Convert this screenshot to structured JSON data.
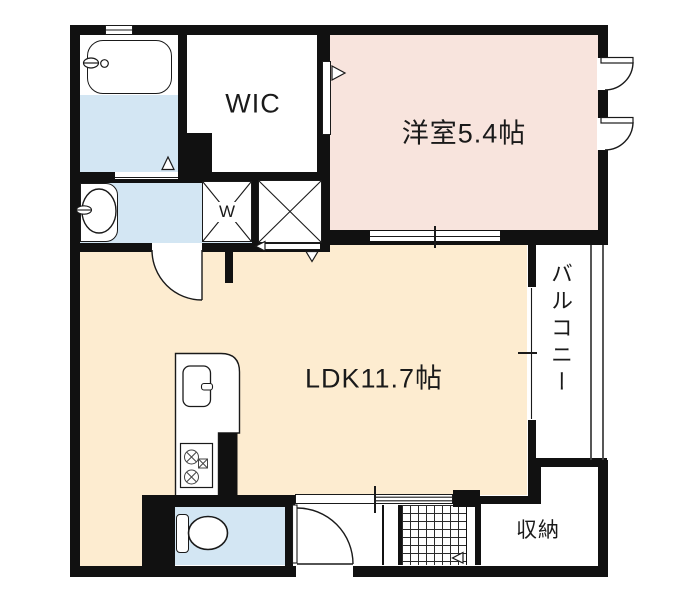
{
  "plan": {
    "title": "1LDK apartment floor plan",
    "rooms": {
      "bedroom": {
        "label": "洋室5.4帖"
      },
      "ldk": {
        "label": "LDK11.7帖"
      },
      "wic": {
        "label": "WIC"
      },
      "balcony": {
        "label": "バルコニー"
      },
      "storage": {
        "label": "収納"
      },
      "washing_machine": {
        "label": "W"
      }
    },
    "fixtures": [
      "bathtub",
      "bathtub-faucet",
      "washbasin",
      "toilet",
      "kitchen-sink",
      "kitchen-counter",
      "gas-stove",
      "washing-machine-space",
      "cross-box-storage",
      "entrance-tile-grid",
      "balcony-railing",
      "entrance-door",
      "room-doors",
      "sliding-doors",
      "casement-windows"
    ],
    "colors": {
      "wall": "#111111",
      "bedroom_fill": "#f8e4dd",
      "ldk_fill": "#fdecd0",
      "wet_fill": "#d3e6f3",
      "line": "#1a1a1a",
      "bg": "#ffffff"
    }
  }
}
